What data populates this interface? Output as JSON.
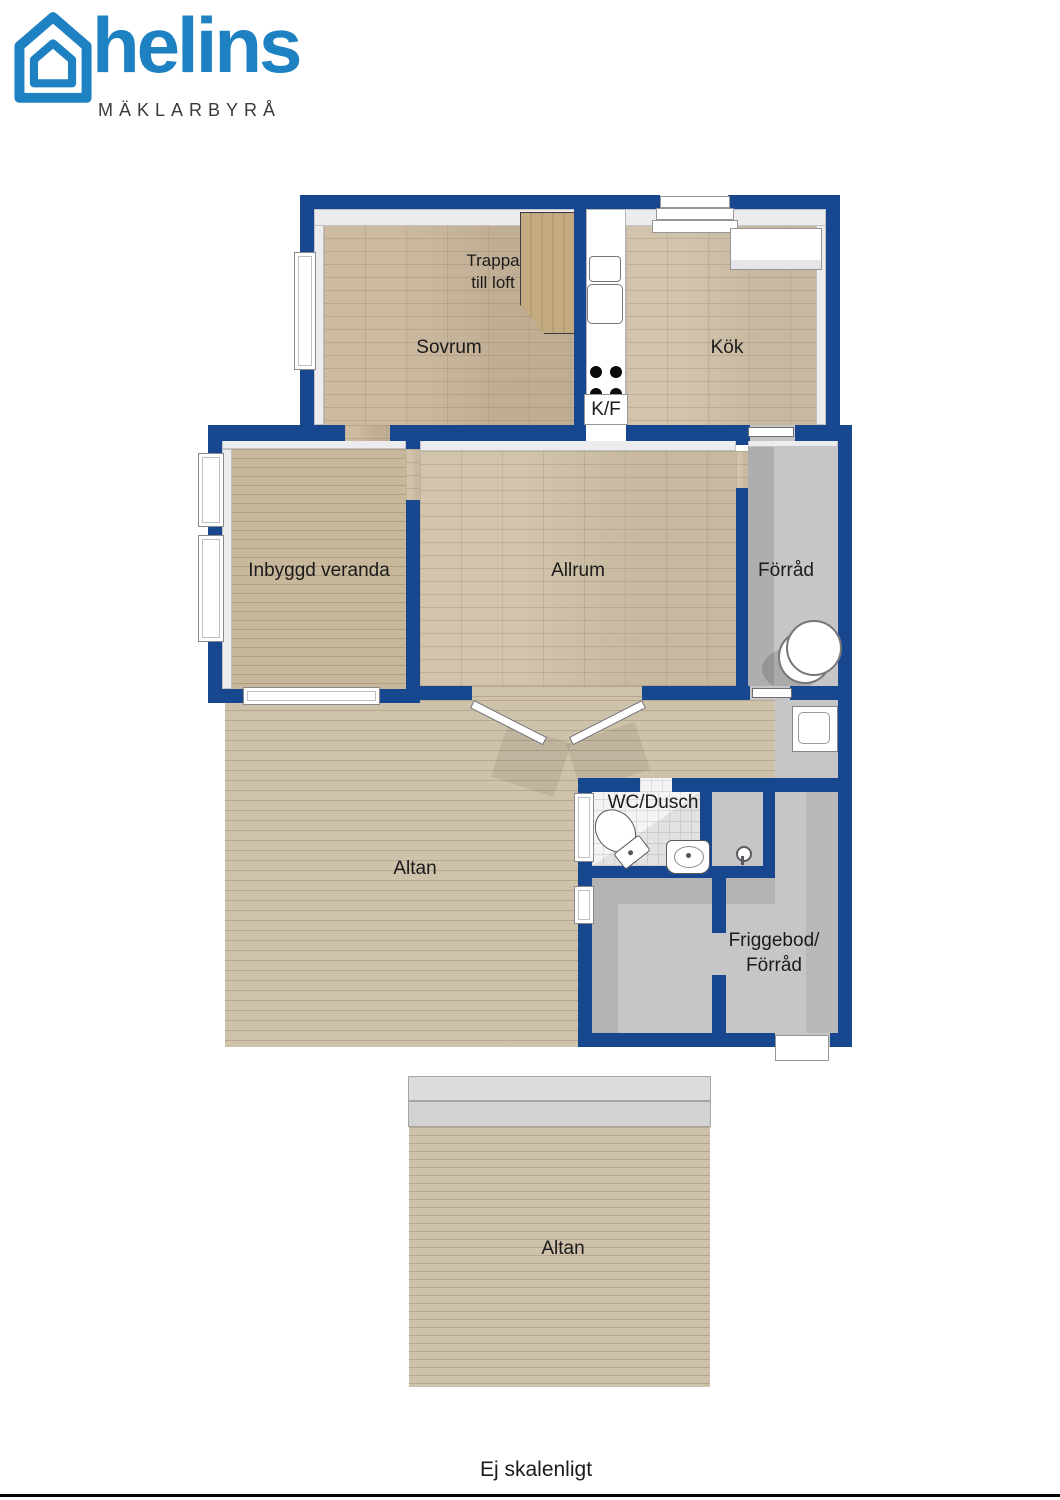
{
  "brand": {
    "name": "helins",
    "tagline": "MÄKLARBYRÅ",
    "logo_color": "#1e81c2",
    "tagline_color": "#3b3b3b"
  },
  "floorplan": {
    "colors": {
      "wall_blue": "#17488f",
      "parquet_floor": "#c8b59a",
      "deck_floor": "#cfc2ab",
      "veranda_floor": "#c7b79b",
      "storage_gray_floor": "#c6c6c8",
      "bathroom_tile": "#f4f4f4"
    },
    "labels": {
      "sovrum": "Sovrum",
      "trappa_line1": "Trappa",
      "trappa_line2": "till loft",
      "kok": "Kök",
      "kf": "K/F",
      "inbyggd_veranda": "Inbyggd veranda",
      "allrum": "Allrum",
      "forrad": "Förråd",
      "wc_dusch": "WC/Dusch",
      "altan_ovre": "Altan",
      "friggebod_line1": "Friggebod/",
      "friggebod_line2": "Förråd",
      "altan_nedre": "Altan"
    },
    "icons": {
      "logo": "house-outline-icon",
      "kitchen_sink": "kitchen-sink-icon",
      "stove": "stove-burners-icon",
      "kitchen_counter": "kitchen-counter",
      "entrance_steps": "entrance-steps",
      "stairs": "staircase",
      "water_heater": "water-heater-icon",
      "outdoor_sink": "outdoor-sink-icon",
      "toilet": "toilet-icon",
      "washbasin": "washbasin-icon",
      "shower": "shower-icon",
      "french_doors": "french-doors",
      "window": "window"
    }
  },
  "footer": {
    "note": "Ej skalenligt"
  }
}
